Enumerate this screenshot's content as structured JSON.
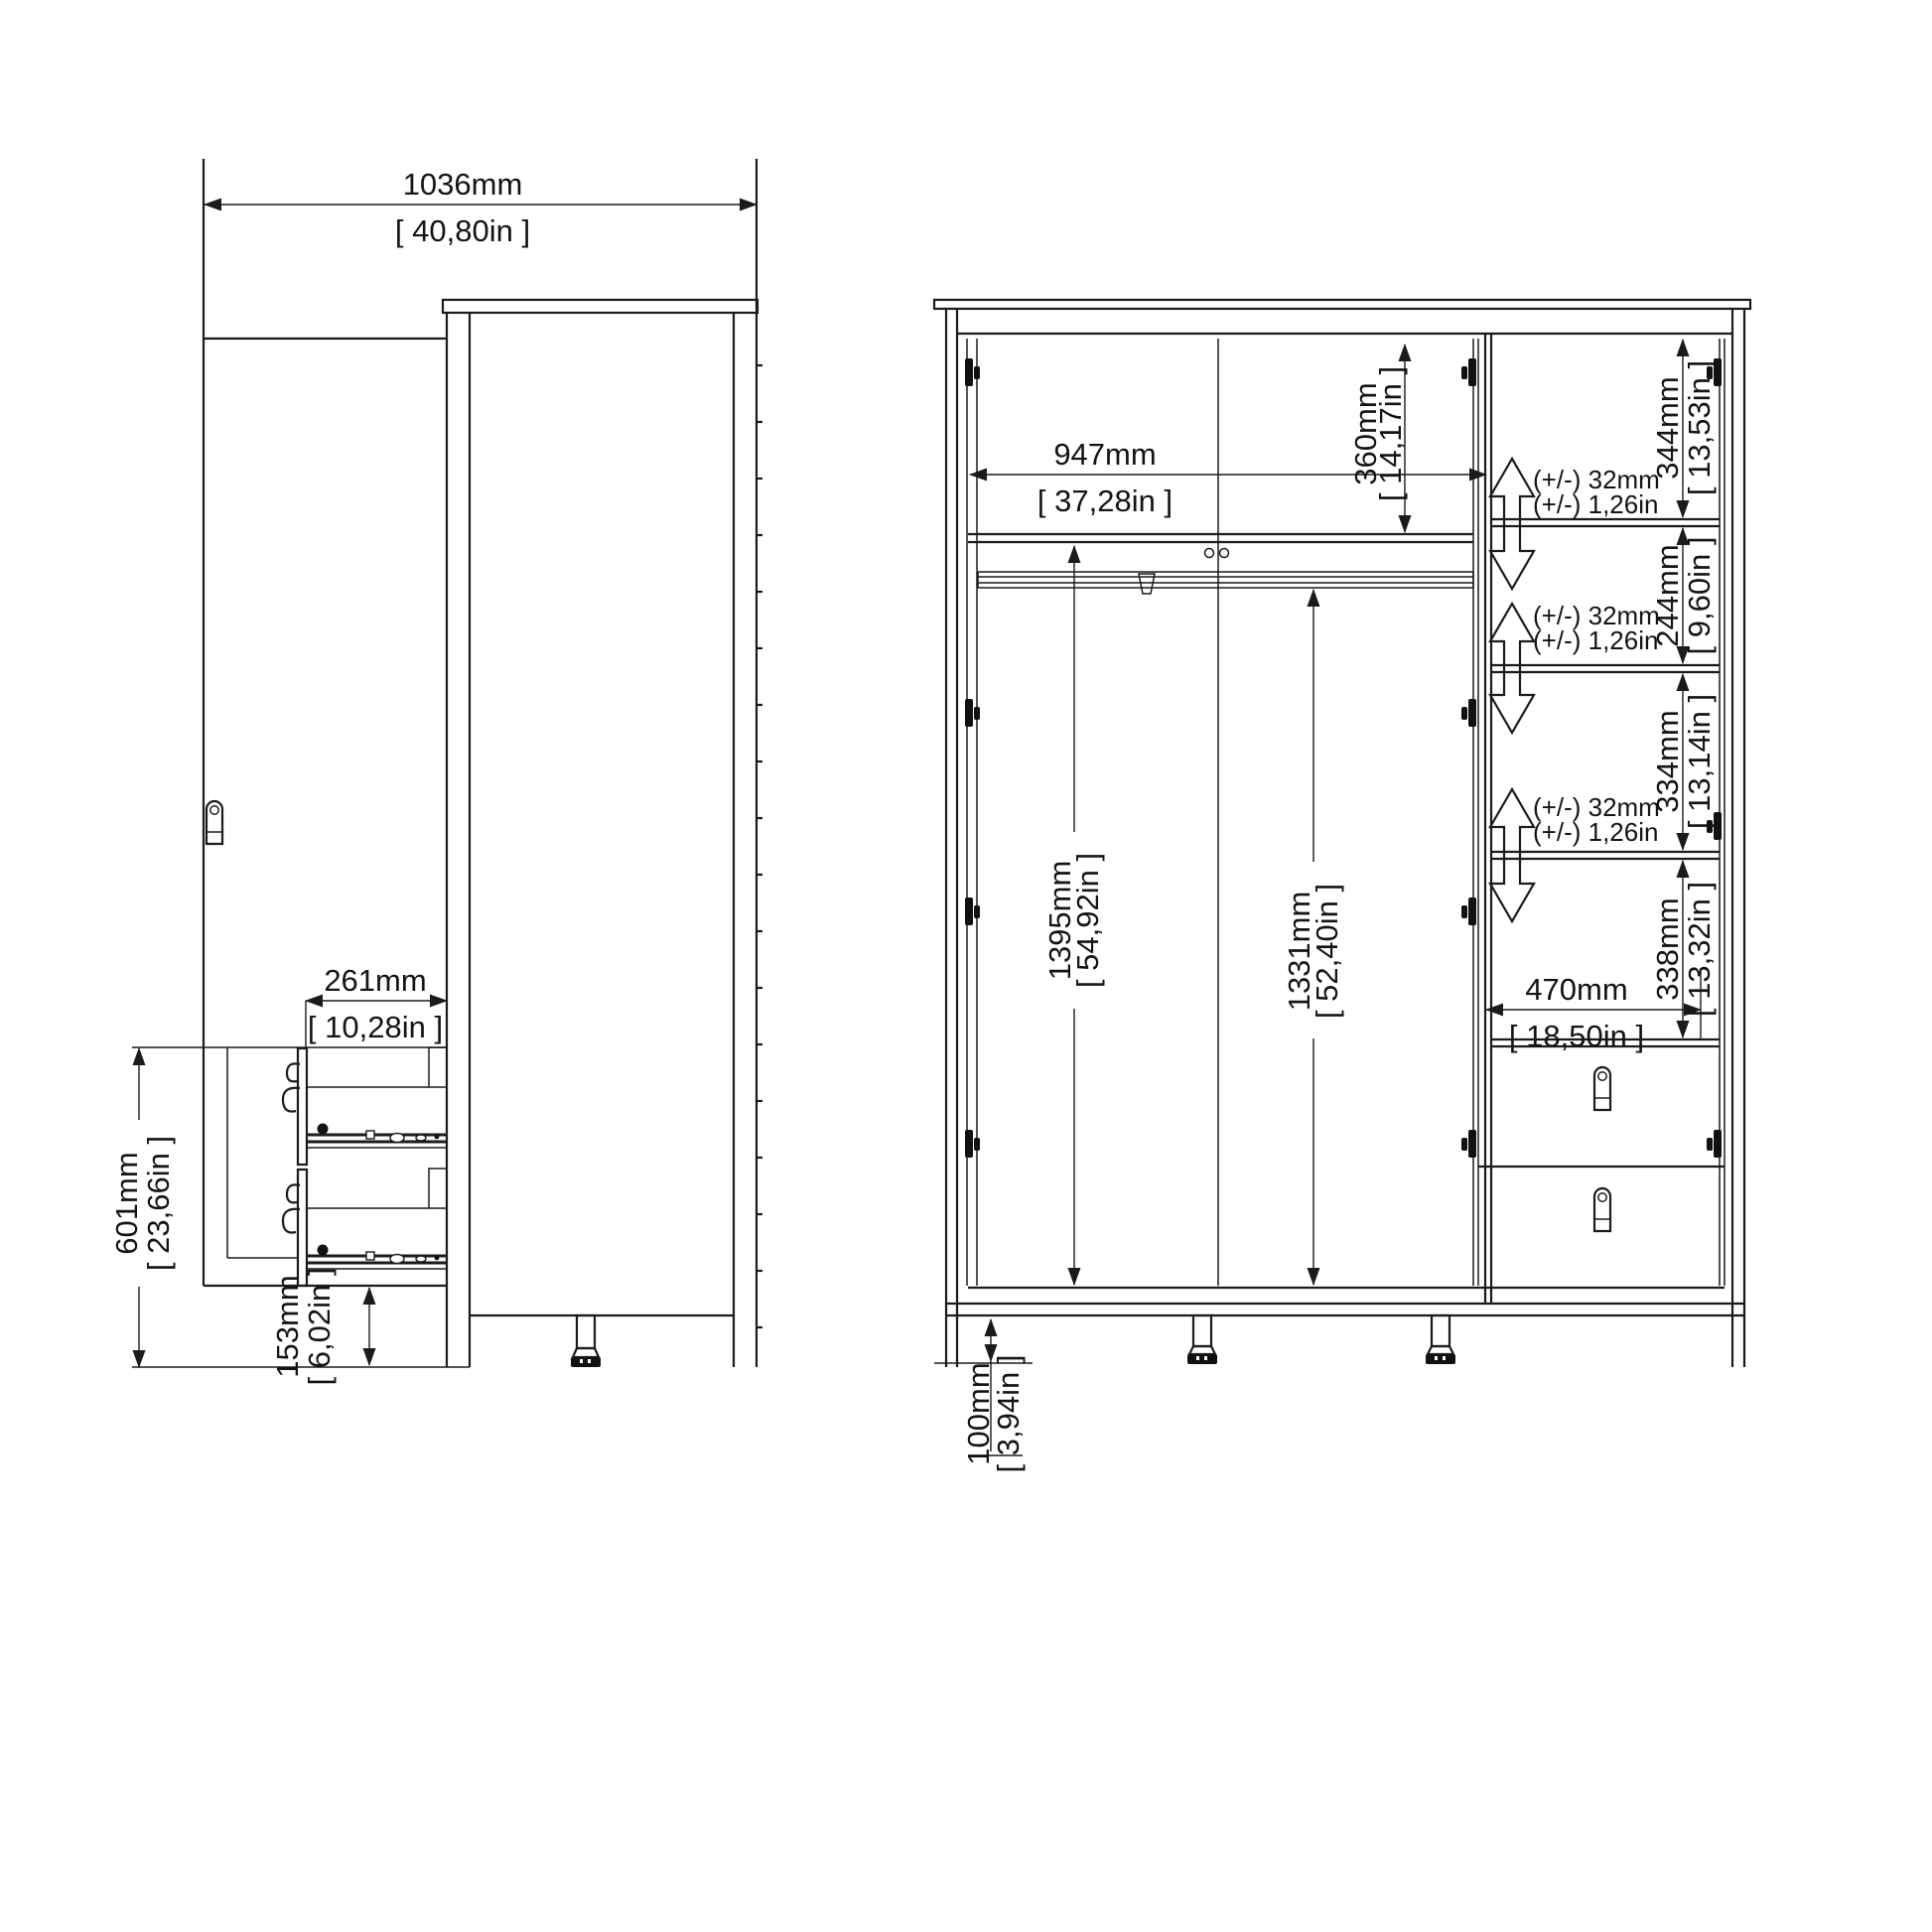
{
  "drawing": {
    "title": "wardrobe-dimension-drawing",
    "views": {
      "side": "side-view-open-door",
      "front": "front-view-interior"
    },
    "dims": {
      "overall_width": {
        "mm": "1036mm",
        "in": "[ 40,80in ]"
      },
      "drawer_depth": {
        "mm": "261mm",
        "in": "[ 10,28in ]"
      },
      "drawer_unit_height": {
        "mm": "601mm",
        "in": "[ 23,66in ]"
      },
      "plinth_height": {
        "mm": "153mm",
        "in": "[ 6,02in ]"
      },
      "interior_width": {
        "mm": "947mm",
        "in": "[ 37,28in ]"
      },
      "top_shelf_height": {
        "mm": "360mm",
        "in": "[ 14,17in ]"
      },
      "shelf_gap_1": {
        "mm": "344mm",
        "in": "[ 13,53in ]"
      },
      "shelf_gap_2": {
        "mm": "244mm",
        "in": "[ 9,60in ]"
      },
      "shelf_gap_3": {
        "mm": "334mm",
        "in": "[ 13,14in ]"
      },
      "shelf_gap_4": {
        "mm": "338mm",
        "in": "[ 13,32in ]"
      },
      "shelf_width": {
        "mm": "470mm",
        "in": "[ 18,50in ]"
      },
      "hanging_height_left": {
        "mm": "1395mm",
        "in": "[ 54,92in ]"
      },
      "hanging_height_right": {
        "mm": "1331mm",
        "in": "[ 52,40in ]"
      },
      "foot_height": {
        "mm": "100mm",
        "in": "[ 3,94in ]"
      },
      "shelf_adjust": {
        "mm": "(+/-) 32mm",
        "in": "(+/-) 1,26in"
      }
    },
    "colors": {
      "line": "#1b1b1b",
      "background": "#ffffff"
    }
  }
}
